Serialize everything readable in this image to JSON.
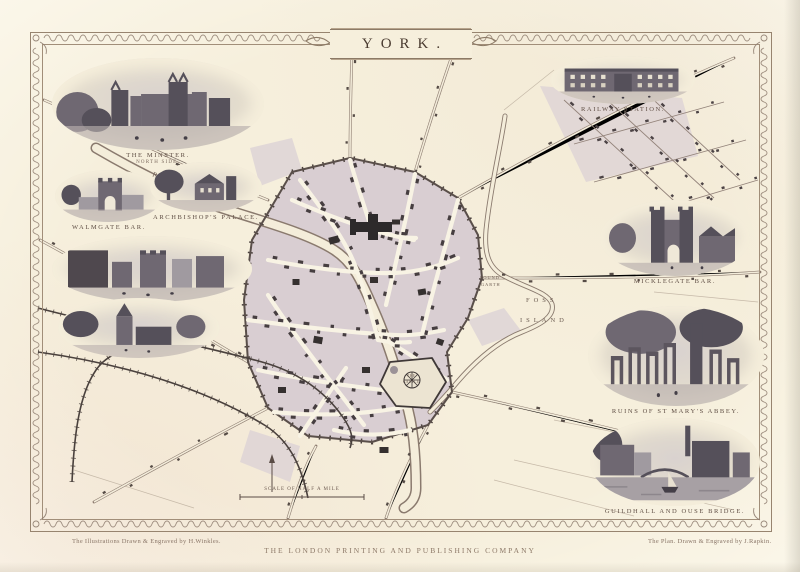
{
  "sheet": {
    "title": "YORK.",
    "imprint_left": "The Illustrations Drawn & Engraved by H.Winkles.",
    "imprint_center": "THE LONDON PRINTING AND PUBLISHING COMPANY",
    "imprint_right": "The Plan. Drawn & Engraved by J.Rapkin."
  },
  "vignettes": [
    {
      "caption": "THE MINSTER.",
      "subcaption": "NORTH SIDE."
    },
    {
      "caption": "WALMGATE BAR."
    },
    {
      "caption": "ARCHBISHOP'S PALACE."
    },
    {
      "caption": "THE CASTLE."
    },
    {
      "caption": ""
    },
    {
      "caption": "RAILWAY STATION."
    },
    {
      "caption": "MICKLEGATE BAR."
    },
    {
      "caption": "RUINS OF ST MARY'S ABBEY."
    },
    {
      "caption": "GUILDHALL AND OUSE BRIDGE."
    }
  ],
  "map": {
    "river_label": "RIVER OUSE",
    "foss_island": [
      "FOSS",
      "ISLAND"
    ],
    "pound_garth": [
      "POUND",
      "GARTH"
    ],
    "castle_label": [
      "THE",
      "CASTLE"
    ],
    "railway_label": "YORK & SCARBOROUGH RAILWAY",
    "scale_label": "SCALE OF HALF A MILE"
  },
  "colors": {
    "paper": "#f6efdc",
    "city_block": "#d9ced2",
    "ink": "#5d4f48",
    "dark_building": "#433a3c",
    "frame_ornament": "#8f7e70"
  }
}
